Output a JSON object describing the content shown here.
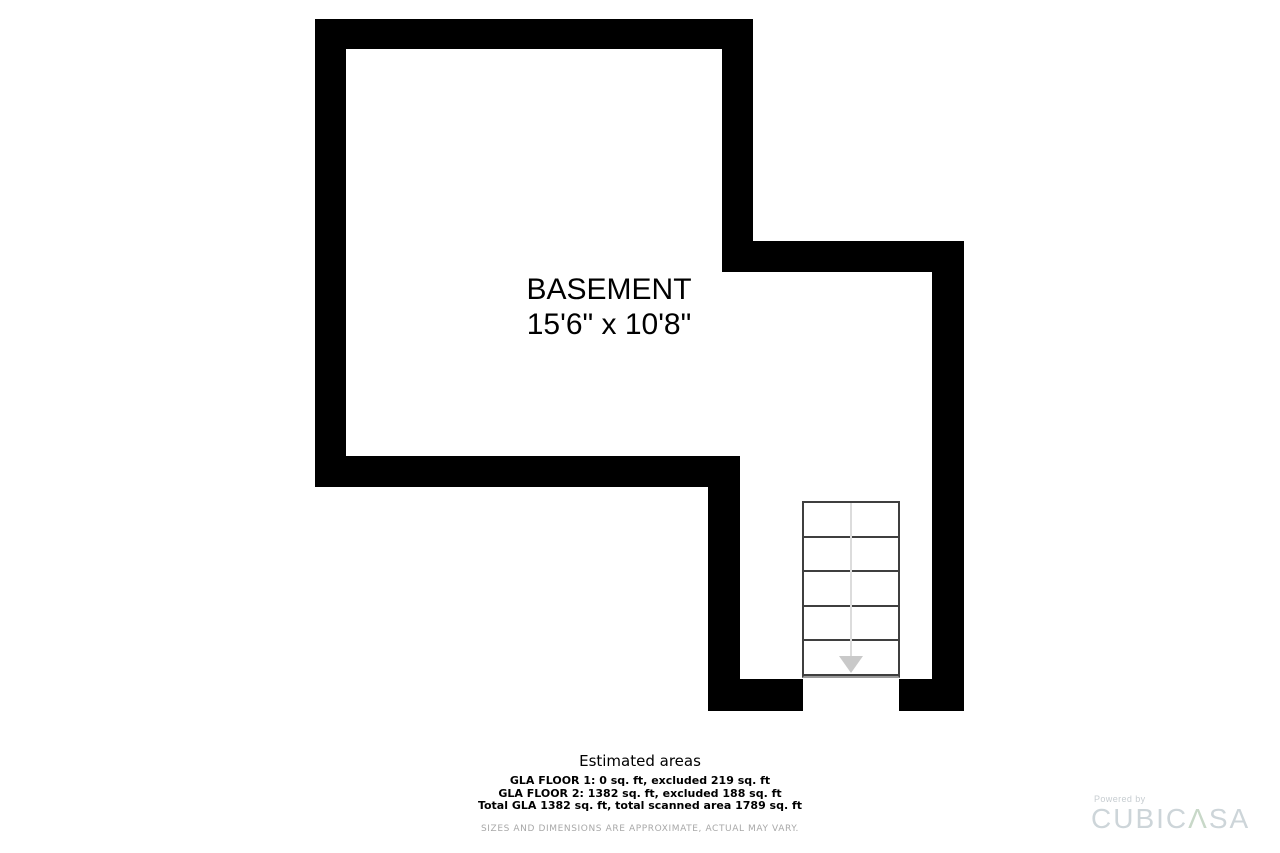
{
  "page": {
    "background": "#ffffff",
    "wall_color": "#000000"
  },
  "floorplan": {
    "room": {
      "label": "BASEMENT",
      "dimensions": "15'6\" x 10'8\""
    },
    "stairs": {
      "steps": 5,
      "direction": "down",
      "line_color": "#3f3f3f",
      "guide_color": "#dcdcdc",
      "arrow_color": "#c9c9c9"
    }
  },
  "areas": {
    "title": "Estimated areas",
    "lines": [
      "GLA FLOOR 1: 0 sq. ft, excluded 219 sq. ft",
      "GLA FLOOR 2: 1382 sq. ft, excluded 188 sq. ft",
      "Total GLA 1382 sq. ft, total scanned area 1789 sq. ft"
    ]
  },
  "disclaimer": "SIZES AND DIMENSIONS ARE APPROXIMATE, ACTUAL MAY VARY.",
  "logo": {
    "powered_by": "Powered by",
    "brand": "CUBICASA",
    "brand_parts": {
      "prefix": "CUBIC",
      "accent": "Λ",
      "suffix": "SA"
    },
    "text_color": "#cdd5d9",
    "accent_color": "#c8d8c8"
  }
}
